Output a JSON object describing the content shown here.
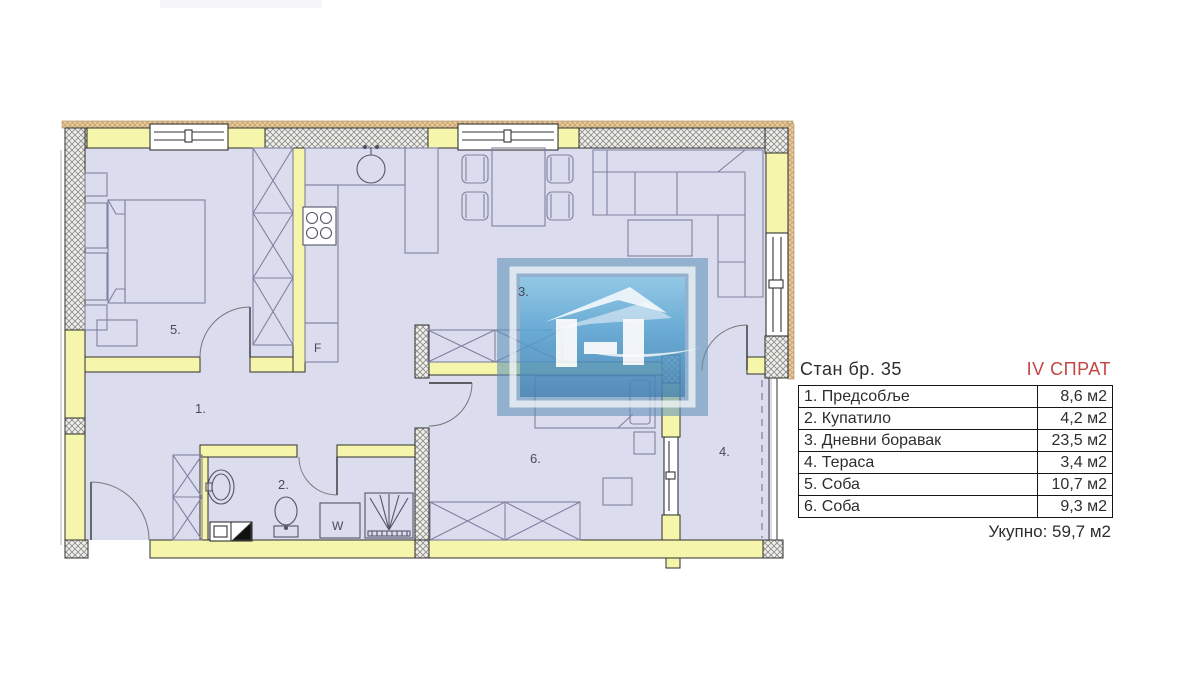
{
  "plan": {
    "labels": {
      "hall": "1.",
      "bath": "2.",
      "living": "3.",
      "terrace": "4.",
      "bedroom5": "5.",
      "bedroom6": "6.",
      "fridge": "F",
      "washer": "W"
    }
  },
  "table": {
    "title": "Стан бр. 35",
    "floor": "IV СПРАТ",
    "rows": [
      {
        "name": "1. Предсобље",
        "area": "8,6 м2"
      },
      {
        "name": "2. Купатило",
        "area": "4,2 м2"
      },
      {
        "name": "3. Дневни боравак",
        "area": "23,5 м2"
      },
      {
        "name": "4. Тераса",
        "area": "3,4 м2"
      },
      {
        "name": "5. Соба",
        "area": "10,7 м2"
      },
      {
        "name": "6. Соба",
        "area": "9,3 м2"
      }
    ],
    "total": "Укупно: 59,7 м2"
  },
  "colors": {
    "accent_red": "#c34543",
    "wall_yellow": "#f5f5ab",
    "floor_lavender": "#dbdcee",
    "watermark_blue": "#5d90b8"
  }
}
